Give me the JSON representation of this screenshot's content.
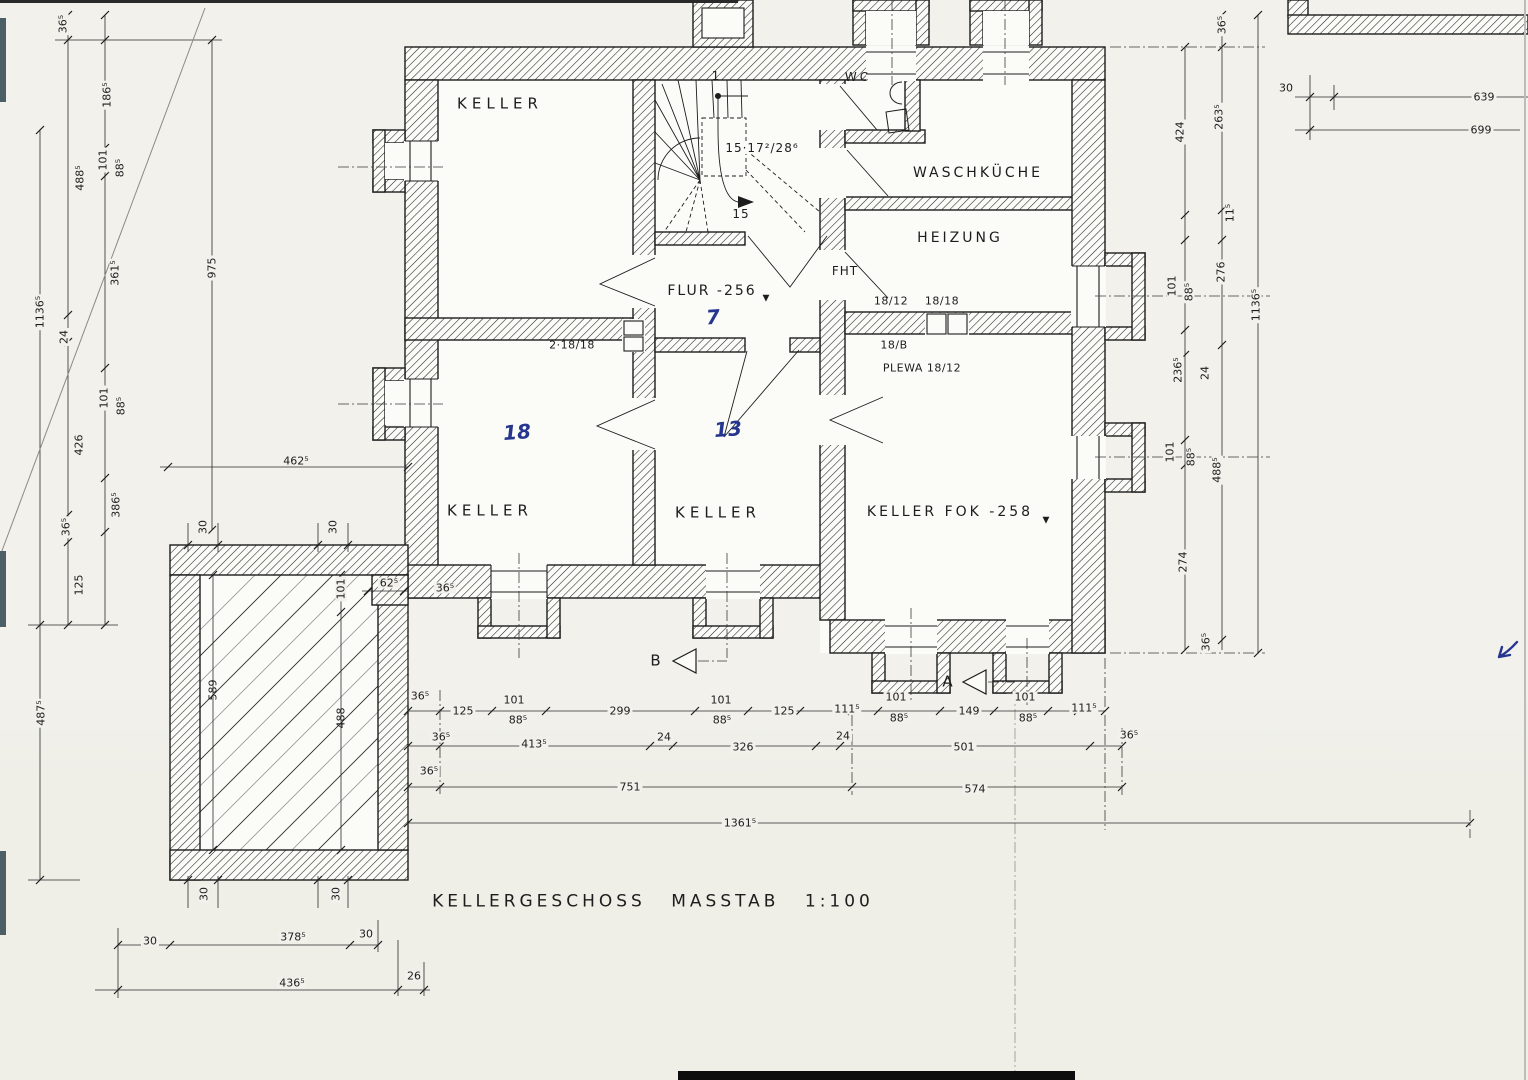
{
  "document": {
    "title": "KELLERGESCHOSS  MASSTAB 1:100",
    "floor": "KELLERGESCHOSS",
    "scale": "1:100"
  },
  "rooms": {
    "keller_top_left": "KELLER",
    "keller_left": "KELLER",
    "keller_mid": "KELLER",
    "keller_fok": "KELLER FOK -258",
    "flur": "FLUR -256",
    "waschkueche": "WASCHKÜCHE",
    "heizung": "HEIZUNG",
    "wc": "WC"
  },
  "stair": {
    "dimensions": "15·17²/28⁶",
    "tread_count": "15",
    "first_tread": "1"
  },
  "annotations": {
    "fht": "FHT",
    "flue_left": "2·18/18",
    "flue_pair_a": "18/12",
    "flue_pair_b": "18/18",
    "flue_b": "18/B",
    "plewa": "PLEWA 18/12",
    "level_marker": "▼",
    "handwritten_flur": "7",
    "handwritten_keller_left": "18",
    "handwritten_keller_mid": "13"
  },
  "sections": {
    "a": "A",
    "b": "B"
  },
  "dims_left": [
    "36⁵",
    "186⁵",
    "101",
    "88⁵",
    "488⁵",
    "361⁵",
    "24",
    "1136⁵",
    "975",
    "101",
    "88⁵",
    "426",
    "386⁵",
    "36⁵",
    "125",
    "487⁵"
  ],
  "dims_right": [
    "36⁵",
    "424",
    "263⁵",
    "101",
    "88⁵",
    "11⁵",
    "276",
    "1136⁵",
    "236⁵",
    "24",
    "101",
    "88⁵",
    "488⁵",
    "274",
    "36⁵"
  ],
  "dims_top_right": [
    "30",
    "639",
    "699"
  ],
  "dims_bottom_row1": [
    "36⁵",
    "125",
    "101",
    "88⁵",
    "299",
    "101",
    "88⁵",
    "125",
    "111⁵",
    "101",
    "88⁵",
    "149",
    "101",
    "88⁵",
    "111⁵"
  ],
  "dims_bottom_row2": [
    "36⁵",
    "413⁵",
    "24",
    "326",
    "24",
    "501",
    "36⁵"
  ],
  "dims_bottom_row3": [
    "36⁵",
    "751",
    "574"
  ],
  "dims_bottom_row4": [
    "1361⁵"
  ],
  "dims_terrace": [
    "30",
    "30",
    "462⁵",
    "101",
    "62⁵",
    "36⁵",
    "589",
    "488",
    "30",
    "30",
    "30",
    "378⁵",
    "30",
    "436⁵",
    "26"
  ],
  "colors": {
    "ink": "#1d1d1d",
    "blue_ink": "#26368f",
    "paper": "#f2f1ec"
  }
}
